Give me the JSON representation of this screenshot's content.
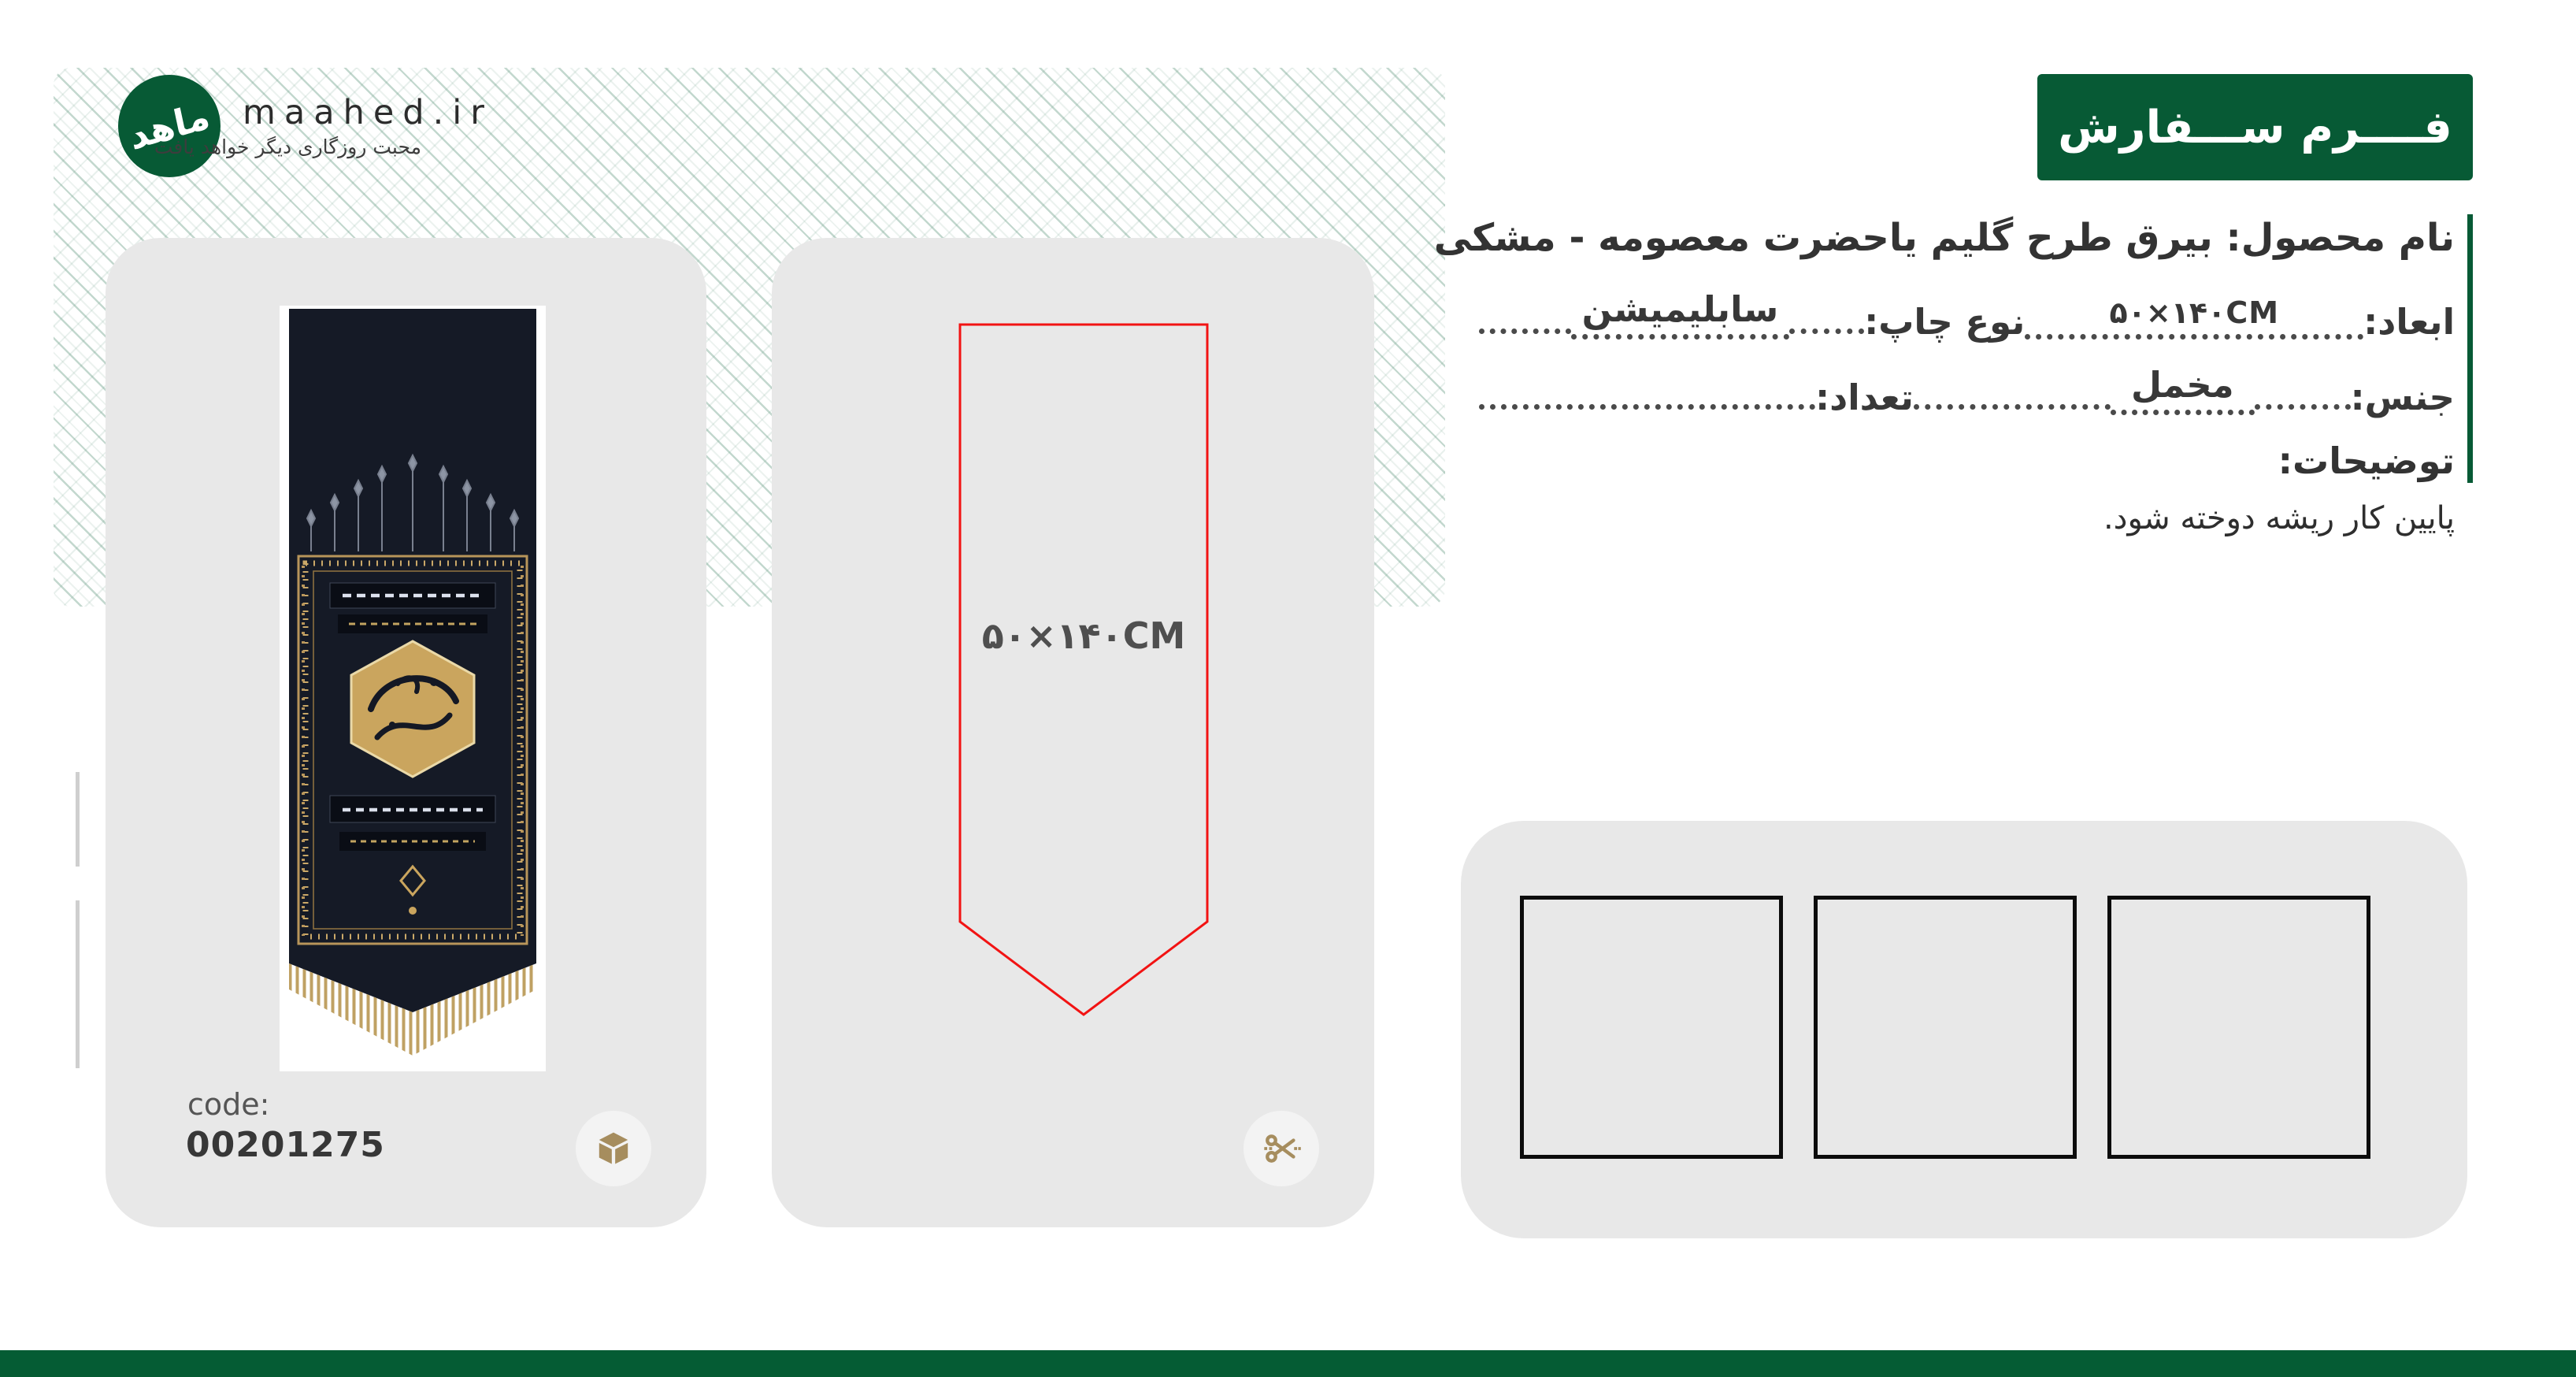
{
  "brand": {
    "logo_text": "ماهد",
    "site": "maahed.ir",
    "tagline": "محبت روزگاری دیگر خواهد یافت"
  },
  "header": {
    "title": "فــــرم ســـفارش"
  },
  "order_form": {
    "product_label": "نام محصول:",
    "product_value": "بیرق طرح گلیم یاحضرت معصومه - مشکی",
    "dimensions_label": "ابعاد:",
    "dimensions_value": "۵۰×۱۴۰CM",
    "print_type_label": "نوع چاپ:",
    "print_type_value": "سابلیمیشن",
    "material_label": "جنس:",
    "material_value": "مخمل",
    "quantity_label": "تعداد:",
    "quantity_value": "",
    "notes_label": "توضیحات:",
    "notes_value": "پایین کار ریشه دوخته شود."
  },
  "product_card": {
    "code_label": "code:",
    "code_value": "00201275"
  },
  "template_card": {
    "size_label": "۵۰×۱۴۰CM"
  },
  "icons": {
    "logo": "maahed-wing-calligraphy",
    "product_card": "package-cube",
    "template_card": "scissors-cut"
  },
  "colors": {
    "brand_green": "#075A35",
    "footer_green": "#055C34",
    "cut_line_red": "#F21313",
    "icon_tan": "#A68D5E",
    "card_gray": "#E8E8E8",
    "hatch_teal": "#689C84"
  }
}
